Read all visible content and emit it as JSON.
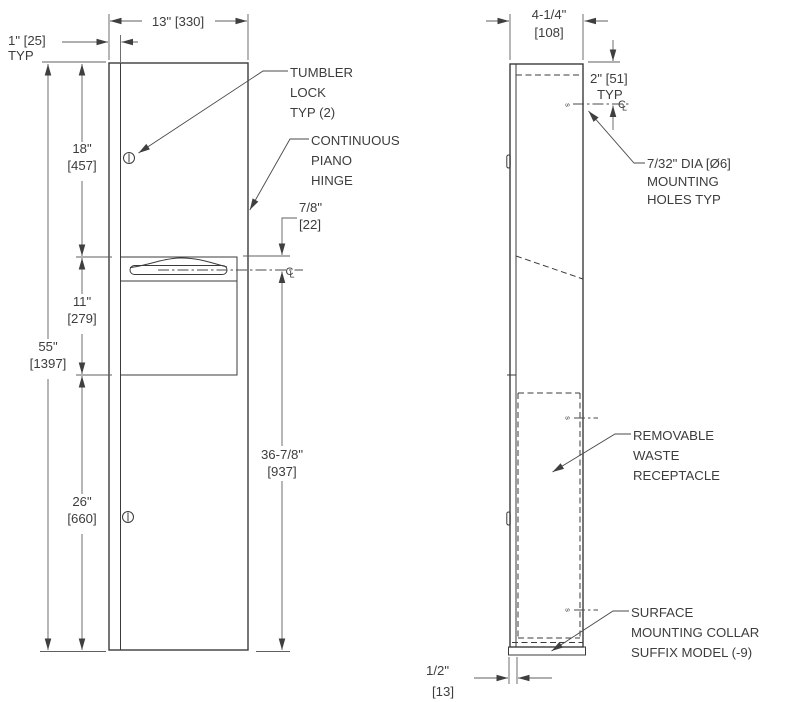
{
  "drawing": {
    "type": "fixture installation drawing",
    "colors": {
      "line": "#3b3b3b",
      "dim_line": "#5f5f5f",
      "text": "#3d3d3d",
      "background": "#ffffff"
    },
    "front_view": {
      "dims": {
        "width": "13\" [330]",
        "flange": "1\" [25]",
        "flange_typ": "TYP",
        "upper_in": "18\"",
        "upper_mm": "[457]",
        "mid_in": "11\"",
        "mid_mm": "[279]",
        "total_in": "55\"",
        "total_mm": "[1397]",
        "lower_in": "26\"",
        "lower_mm": "[660]",
        "slot_in": "7/8\"",
        "slot_mm": "[22]",
        "waste_in": "36-7/8\"",
        "waste_mm": "[937]"
      },
      "labels": {
        "tumbler_lock": [
          "TUMBLER",
          "LOCK",
          "TYP (2)"
        ],
        "piano_hinge": [
          "CONTINUOUS",
          "PIANO",
          "HINGE"
        ]
      },
      "centerline": {
        "c": "C",
        "l": "L"
      }
    },
    "side_view": {
      "dims": {
        "depth_in": "4-1/4\"",
        "depth_mm": "[108]",
        "hole_offset": "2\" [51]",
        "hole_offset_typ": "TYP",
        "collar_in": "1/2\"",
        "collar_mm": "[13]"
      },
      "labels": {
        "mounting_holes": [
          "7/32\" DIA [Ø6]",
          "MOUNTING",
          "HOLES TYP"
        ],
        "waste_receptacle": [
          "REMOVABLE",
          "WASTE",
          "RECEPTACLE"
        ],
        "mounting_collar": [
          "SURFACE",
          "MOUNTING COLLAR",
          "SUFFIX MODEL (-9)"
        ]
      },
      "hole_mark": "s",
      "centerline": {
        "c": "C",
        "l": "L"
      }
    }
  }
}
